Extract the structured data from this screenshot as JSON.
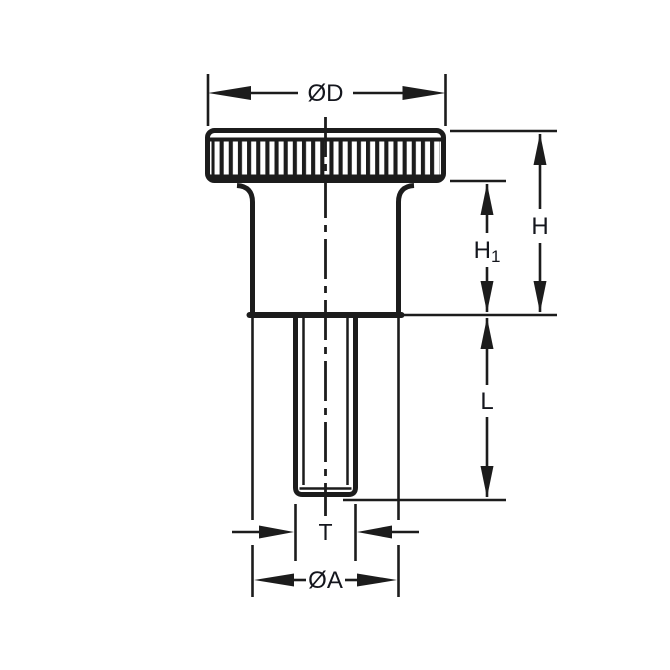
{
  "page": {
    "background": "#ffffff",
    "description": "Technical dimension drawing of a knurled thumb screw (knob with threaded stud), side elevation view"
  },
  "drawing": {
    "line_color": "#1c1c1c",
    "label_color": "#14161d",
    "labels": {
      "top_diameter": "ØD",
      "overall_height": "H",
      "head_height_main": "H",
      "head_height_sub": "1",
      "thread_length": "L",
      "thread_diameter": "T",
      "boss_diameter": "ØA"
    }
  }
}
